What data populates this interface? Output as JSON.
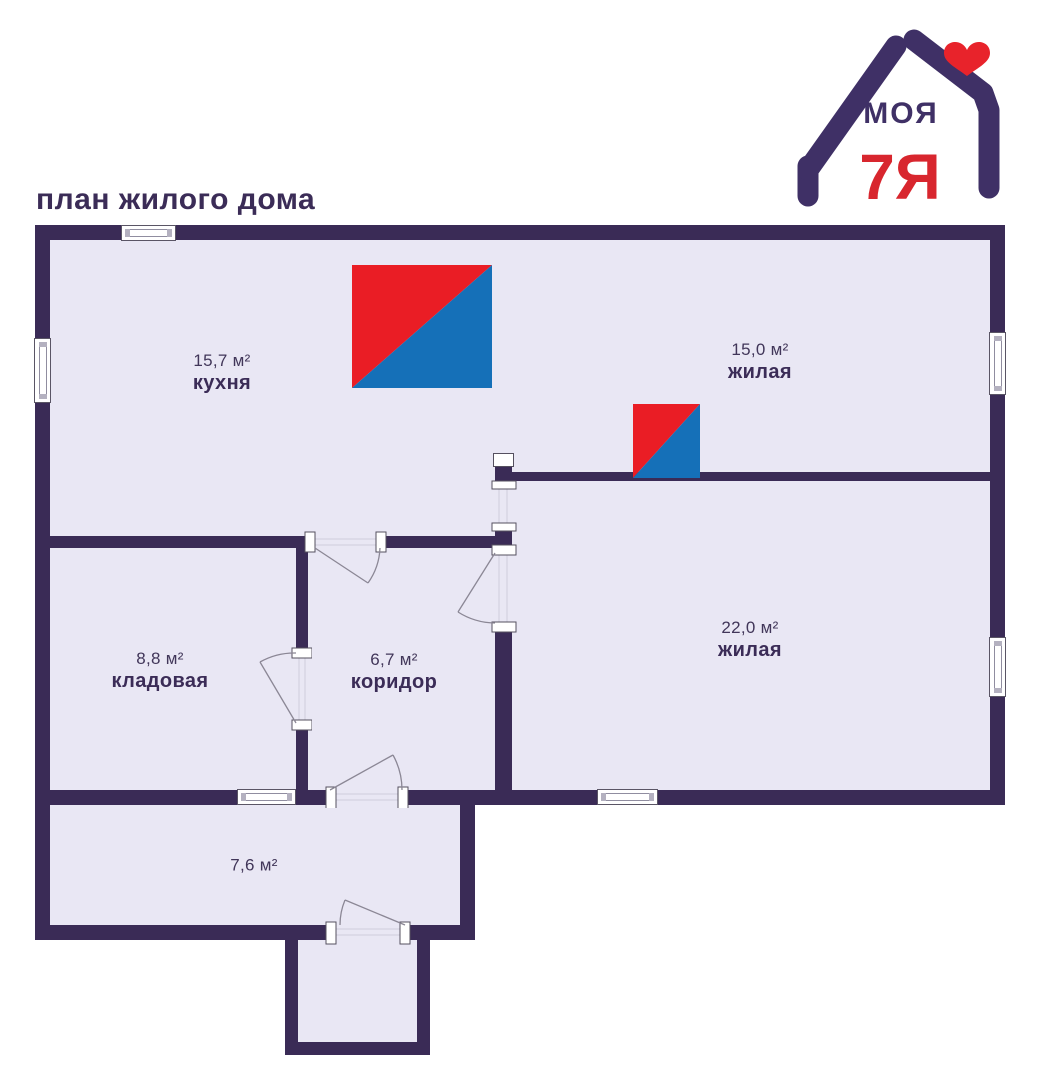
{
  "title": "план жилого дома",
  "logo": {
    "line1": "МОЯ",
    "line2": "7Я",
    "colors": {
      "purple": "#3f3066",
      "red": "#d8262e",
      "heart_red": "#e8232b"
    }
  },
  "palette": {
    "background": "#ffffff",
    "wall": "#3a2b56",
    "floor": "#e9e7f4",
    "text": "#3b2c57",
    "stove_red": "#ea1d25",
    "stove_blue": "#1570b8",
    "door_line": "#8b8795",
    "window_border": "#5a5565"
  },
  "rooms": [
    {
      "id": "kitchen",
      "area": "15,7 м²",
      "name": "кухня"
    },
    {
      "id": "living-top",
      "area": "15,0 м²",
      "name": "жилая"
    },
    {
      "id": "living-right",
      "area": "22,0 м²",
      "name": "жилая"
    },
    {
      "id": "storage",
      "area": "8,8 м²",
      "name": "кладовая"
    },
    {
      "id": "corridor",
      "area": "6,7 м²",
      "name": "коридор"
    },
    {
      "id": "veranda",
      "area": "7,6 м²",
      "name": ""
    }
  ]
}
